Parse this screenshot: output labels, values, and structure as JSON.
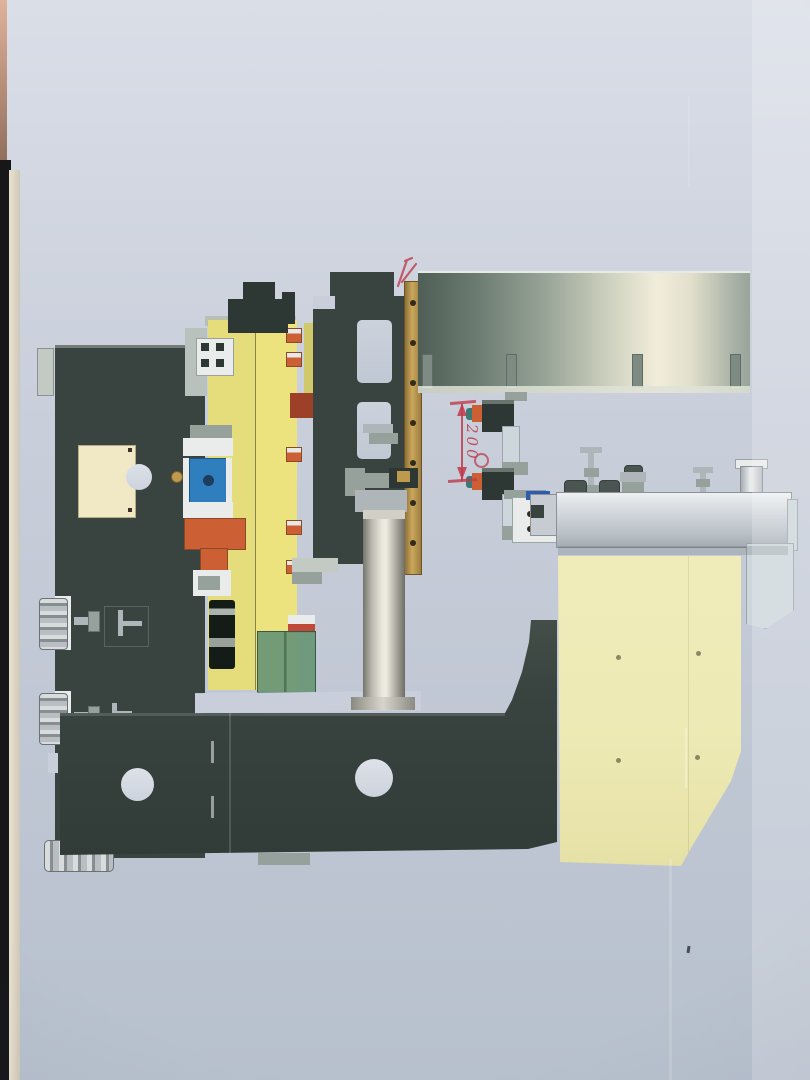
{
  "photo": {
    "kind": "photograph of printed CAD side-view rendering of an industrial press machine, drawing rotated 90 degrees on the page",
    "paper_edge_colors": {
      "table_black": "#17171a",
      "paper_edge_cream": "#eae2d0",
      "top_left_pink": "#e0b29a"
    }
  },
  "palette": {
    "paper_top": "#dadee7",
    "paper_mid": "#c8ceda",
    "paper_bottom": "#b7c0cd",
    "edge_black": "#17171a",
    "edge_cream": "#eae2d0",
    "edge_pink": "#e0b29a",
    "frame_dark": "#39433f",
    "frame_darker": "#2d3733",
    "beam_yellow_l": "#e5dc7c",
    "beam_yellow_r": "#ece37f",
    "cream_block": "#f1e9c5",
    "pale_yellow": "#eeeab5",
    "brass": "#bd9a4e",
    "steel": "#aeb6ba",
    "mid_gray": "#97a19b",
    "light_gray": "#c3cac4",
    "white_part": "#e9ecea",
    "box_gray_top": "#eef0f2",
    "box_gray": "#c6ccd2",
    "bracket_gray": "#ccd6db",
    "blue_part": "#2f7fbe",
    "blue_strip": "#2b5cb0",
    "orange_part": "#cd5f35",
    "red_part": "#c04a38",
    "red_brown": "#9c4028",
    "green_glass": "#6f9a7d",
    "teal_part": "#3a7a74",
    "ygreen": "#cfc96a",
    "red_ink": "#bf3b4b",
    "metal_panel_dark": "#5d6d64",
    "metal_panel_light": "#f1edda",
    "cyl_light": "#efece2",
    "cyl_dark": "#74746c"
  },
  "annotations": {
    "dimension_label": "200",
    "marks": [
      "double-headed vertical dimension arrow between two clamp units",
      "red scribble arrow at top of brass rail",
      "small red circle near lower clamp"
    ]
  },
  "parts": [
    {
      "name": "dark-side-frame-plate",
      "color": "#39433f"
    },
    {
      "name": "yellow-vertical-beam",
      "color": "#e5dc7c"
    },
    {
      "name": "cream-block-on-frame",
      "color": "#f1e9c5"
    },
    {
      "name": "leveling-foot",
      "color": "#c3cac4"
    },
    {
      "name": "blue-motor-block",
      "color": "#2f7fbe"
    },
    {
      "name": "orange-mount-bracket",
      "color": "#cd5f35"
    },
    {
      "name": "green-glass-guard-box",
      "color": "#6f9a7d"
    },
    {
      "name": "central-plate-with-windows",
      "color": "#39433f"
    },
    {
      "name": "brass-hole-rail",
      "color": "#bd9a4e"
    },
    {
      "name": "large-metal-guard-panel",
      "color": "#5d6d64"
    },
    {
      "name": "hydraulic-cylinder",
      "color": "#b9b7ad"
    },
    {
      "name": "bottom-base-plate",
      "color": "#39433f"
    },
    {
      "name": "clamp-unit-upper",
      "color": "#4a544e"
    },
    {
      "name": "clamp-unit-lower",
      "color": "#4a544e"
    },
    {
      "name": "gray-table-box",
      "color": "#c6ccd2"
    },
    {
      "name": "pale-yellow-cover-plate",
      "color": "#eeeab5"
    },
    {
      "name": "right-sheet-bracket",
      "color": "#ccd6db"
    }
  ]
}
